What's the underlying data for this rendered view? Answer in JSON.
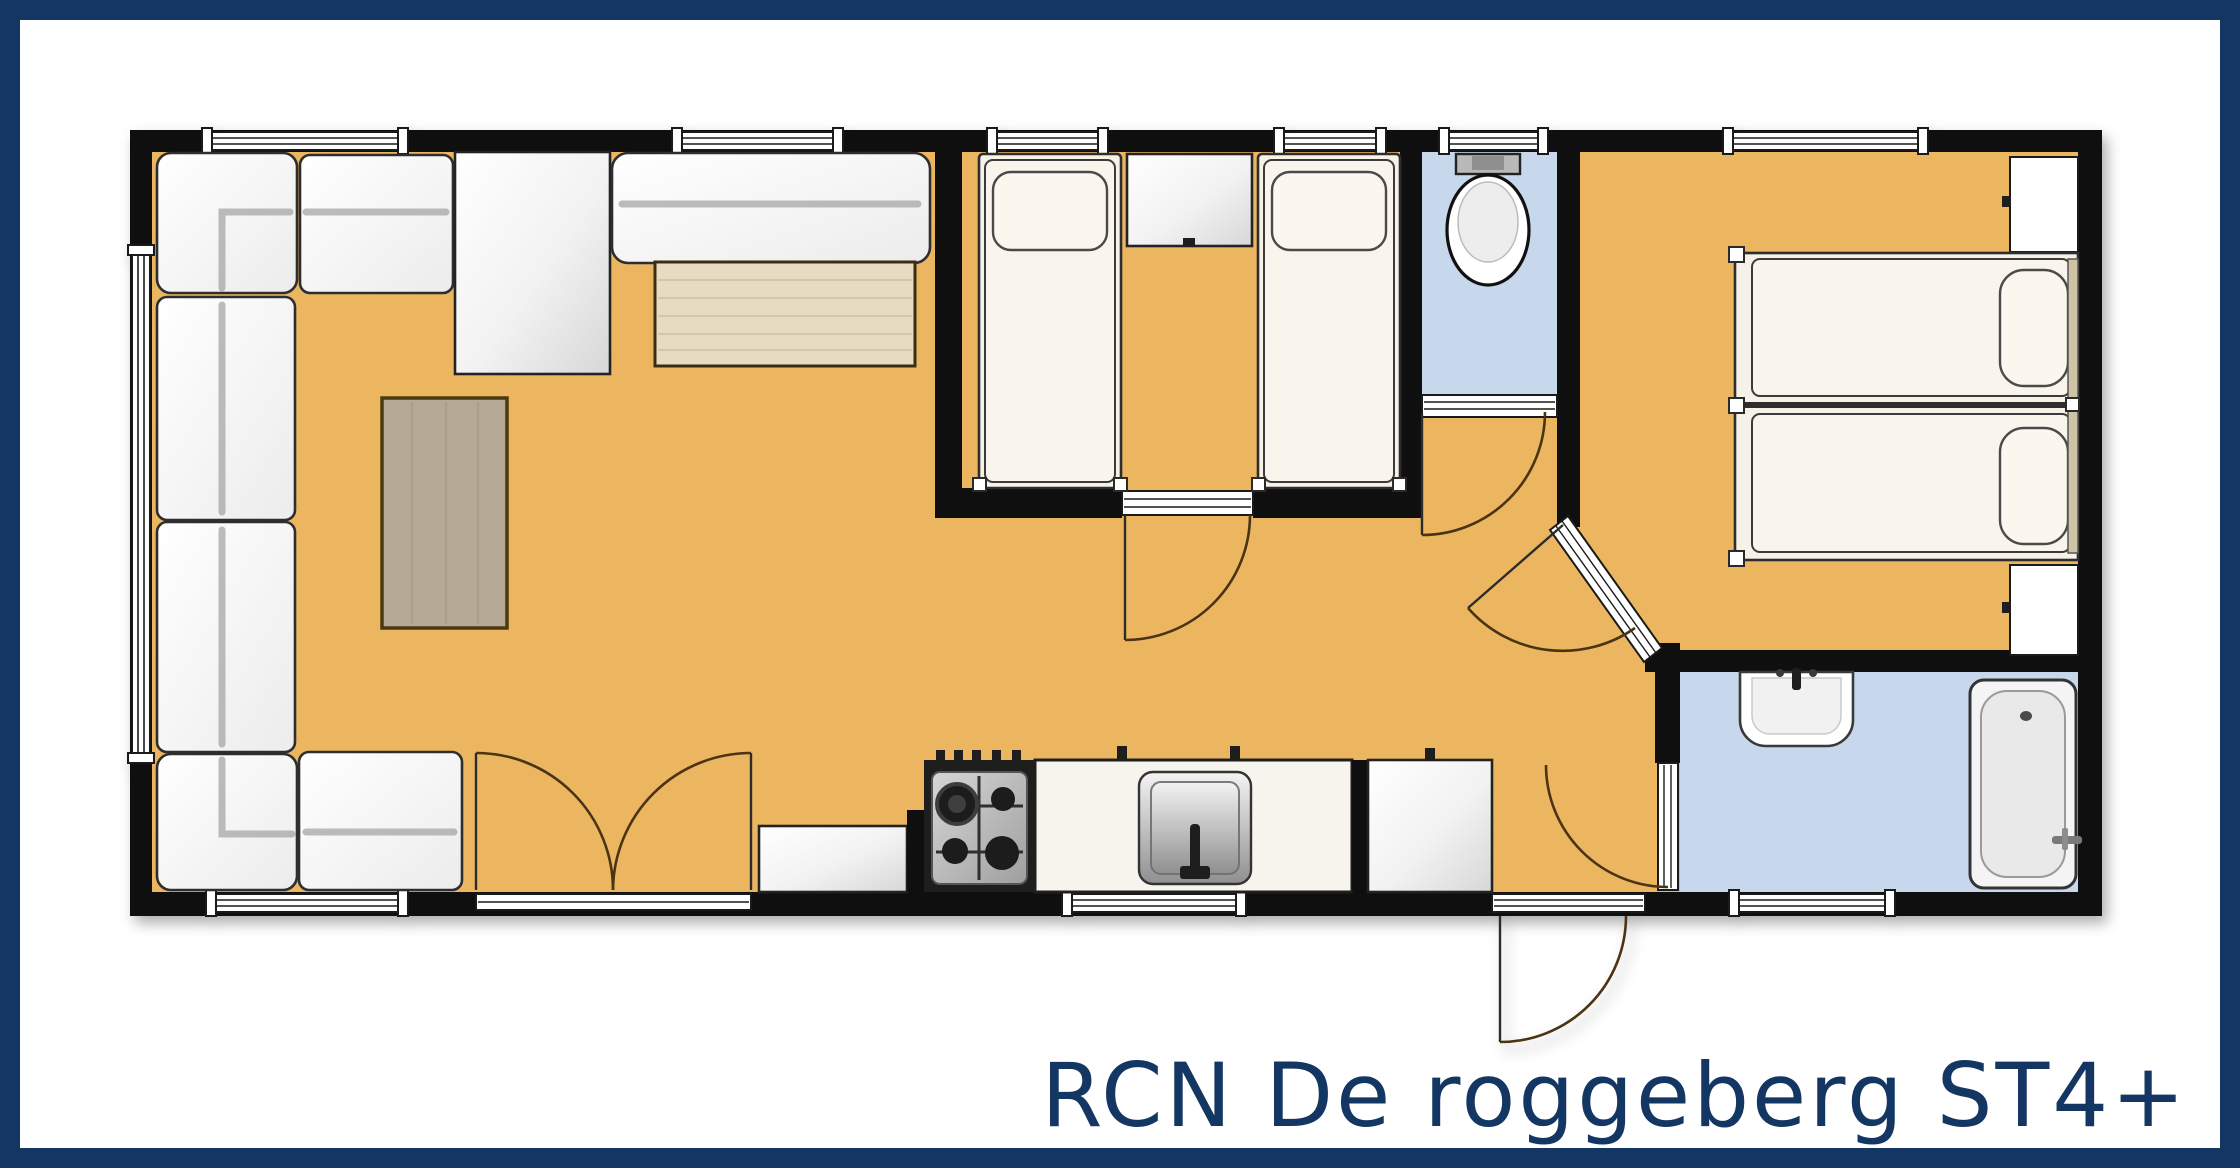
{
  "title": {
    "text": "RCN De roggeberg ST4+"
  },
  "colors": {
    "accent": "#143663",
    "wall": "#0f0f0f",
    "floor_main": "#ecb661",
    "floor_wet": "#c8d8ec",
    "door_arc": "#4a3414",
    "mattress": "#faf5ec",
    "wood_table": "#e7dcc3",
    "coffee_table": "#b5a995",
    "headboard": "#cfc3a5",
    "background": "#ffffff"
  },
  "rooms": [
    {
      "name": "living-room",
      "floor": "main"
    },
    {
      "name": "kitchen",
      "floor": "main"
    },
    {
      "name": "bedroom-twin-middle",
      "floor": "main"
    },
    {
      "name": "toilet",
      "floor": "wet"
    },
    {
      "name": "hallway",
      "floor": "main"
    },
    {
      "name": "bedroom-twin-right",
      "floor": "main"
    },
    {
      "name": "bathroom",
      "floor": "wet"
    }
  ],
  "furniture": [
    {
      "name": "corner-sofa"
    },
    {
      "name": "tv-cabinet"
    },
    {
      "name": "bench-sofa"
    },
    {
      "name": "dining-table"
    },
    {
      "name": "coffee-table"
    },
    {
      "name": "kitchen-cabinet-left"
    },
    {
      "name": "gas-hob"
    },
    {
      "name": "kitchen-sink-counter"
    },
    {
      "name": "kitchen-cabinet-right"
    },
    {
      "name": "single-bed-middle-1"
    },
    {
      "name": "single-bed-middle-2"
    },
    {
      "name": "nightstand"
    },
    {
      "name": "toilet-wc"
    },
    {
      "name": "single-bed-right-1"
    },
    {
      "name": "single-bed-right-2"
    },
    {
      "name": "wardrobe-top"
    },
    {
      "name": "wardrobe-bottom"
    },
    {
      "name": "wash-basin"
    },
    {
      "name": "bathtub"
    }
  ]
}
